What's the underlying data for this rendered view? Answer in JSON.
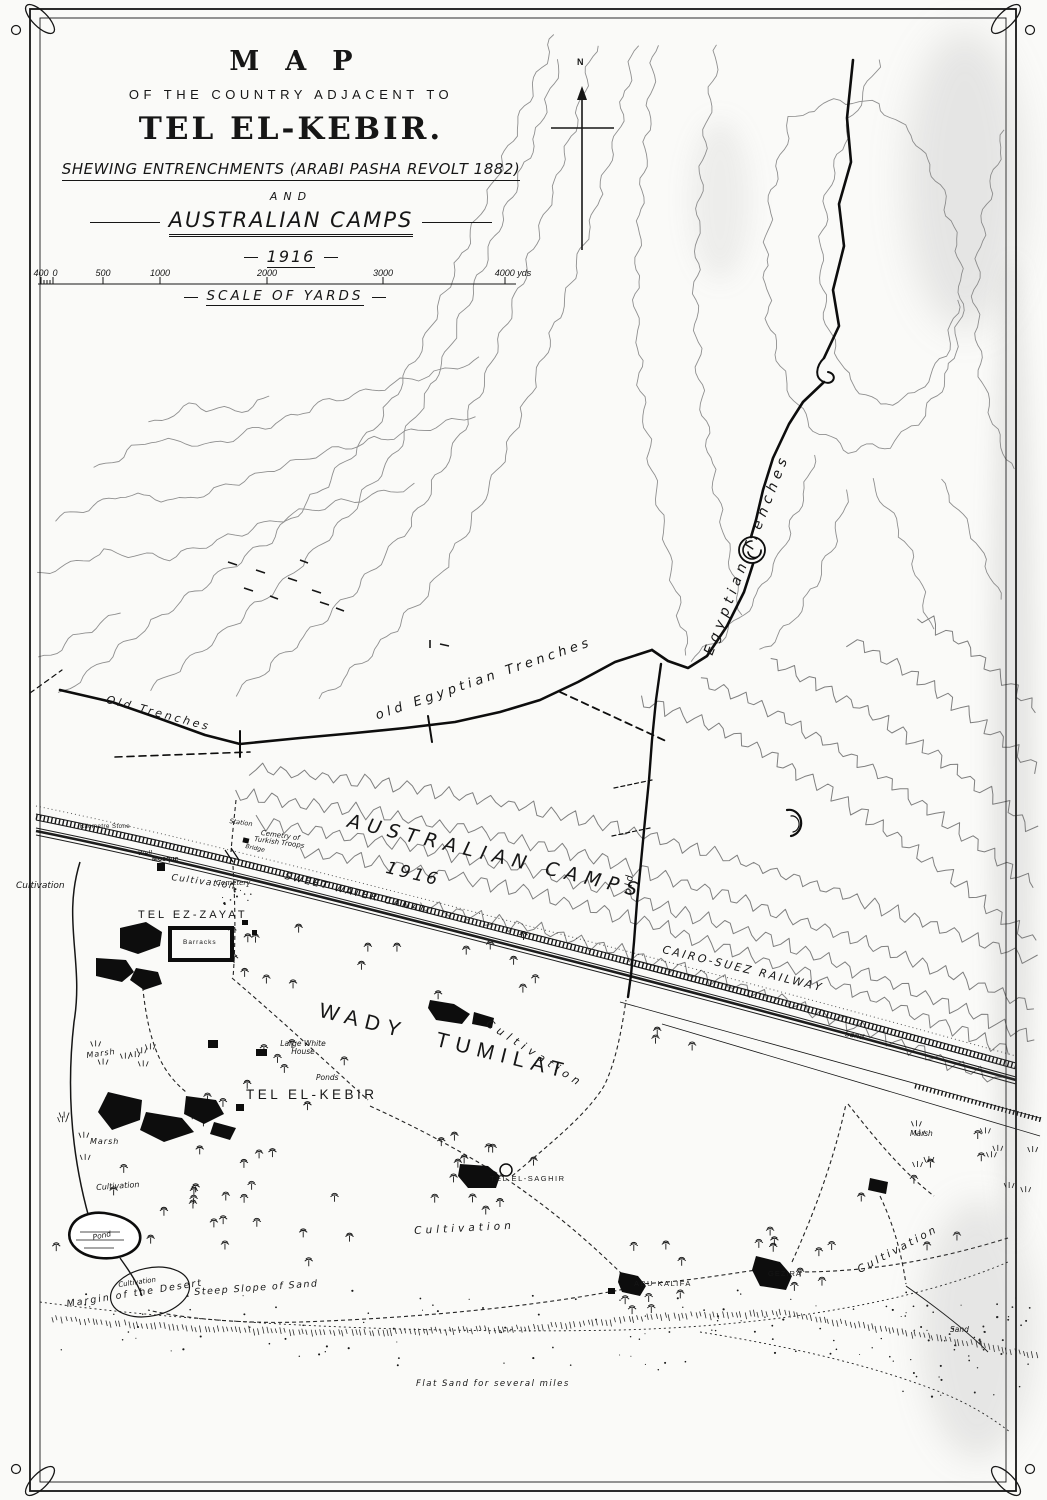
{
  "page": {
    "paper": "#fafaf8",
    "ink": "#161616",
    "contour_color": "#8f8f8f"
  },
  "title_block": {
    "map_word": "MAP",
    "subtitle": "OF THE COUNTRY ADJACENT TO",
    "place": "TEL EL-KEBIR.",
    "shewing": "SHEWING ENTRENCHMENTS (ARABI PASHA REVOLT 1882)",
    "and_word": "AND",
    "camps": "AUSTRALIAN CAMPS",
    "year": "1916"
  },
  "scale_bar": {
    "ticks": [
      "400",
      "0",
      "500",
      "1000",
      "2000",
      "3000",
      "4000 yds"
    ],
    "caption": "SCALE OF YARDS"
  },
  "compass": {
    "north": "N"
  },
  "labels": {
    "old_trenches": "Old Trenches",
    "old_egyptian_trenches": "old Egyptian Trenches",
    "egyptian_trenches": "Egyptian Trenches",
    "old_word": "old",
    "australian_camps": "AUSTRALIAN CAMPS",
    "camps_year": "1916",
    "sweet_water_canal": "SWEET WATER CANAL",
    "cairo_suez_railway": "CAIRO-SUEZ RAILWAY",
    "wady_tumilat": "WADY TUMILAT",
    "cultivation": "Cultivation",
    "marsh": "Marsh",
    "sand": "Sand",
    "pond": "Pond",
    "ponds": "Ponds",
    "large_white_house": "Large White House",
    "tel_ez_zayat": "TEL EZ-ZAYAT",
    "tel_el_kebir": "TEL EL-KEBIR",
    "tel_el_saghir": "TEL EL-SAGHIR",
    "abu_kalifa": "ABU KALIFA",
    "gezira": "GEZIRA",
    "barracks": "Barracks",
    "mosque": "Mosque",
    "cemetery": "Cemetery",
    "well": "Well",
    "station": "Station",
    "bridge": "Bridge",
    "kilometre_stone": "Kilometre Stone",
    "cemetery_of_turkish_troops": "Cemetry of Turkish Troops",
    "margin_of_the_desert": "Margin of the Desert",
    "steep_slope_of_sand": "Steep Slope of Sand",
    "flat_sand": "Flat Sand for several miles"
  }
}
